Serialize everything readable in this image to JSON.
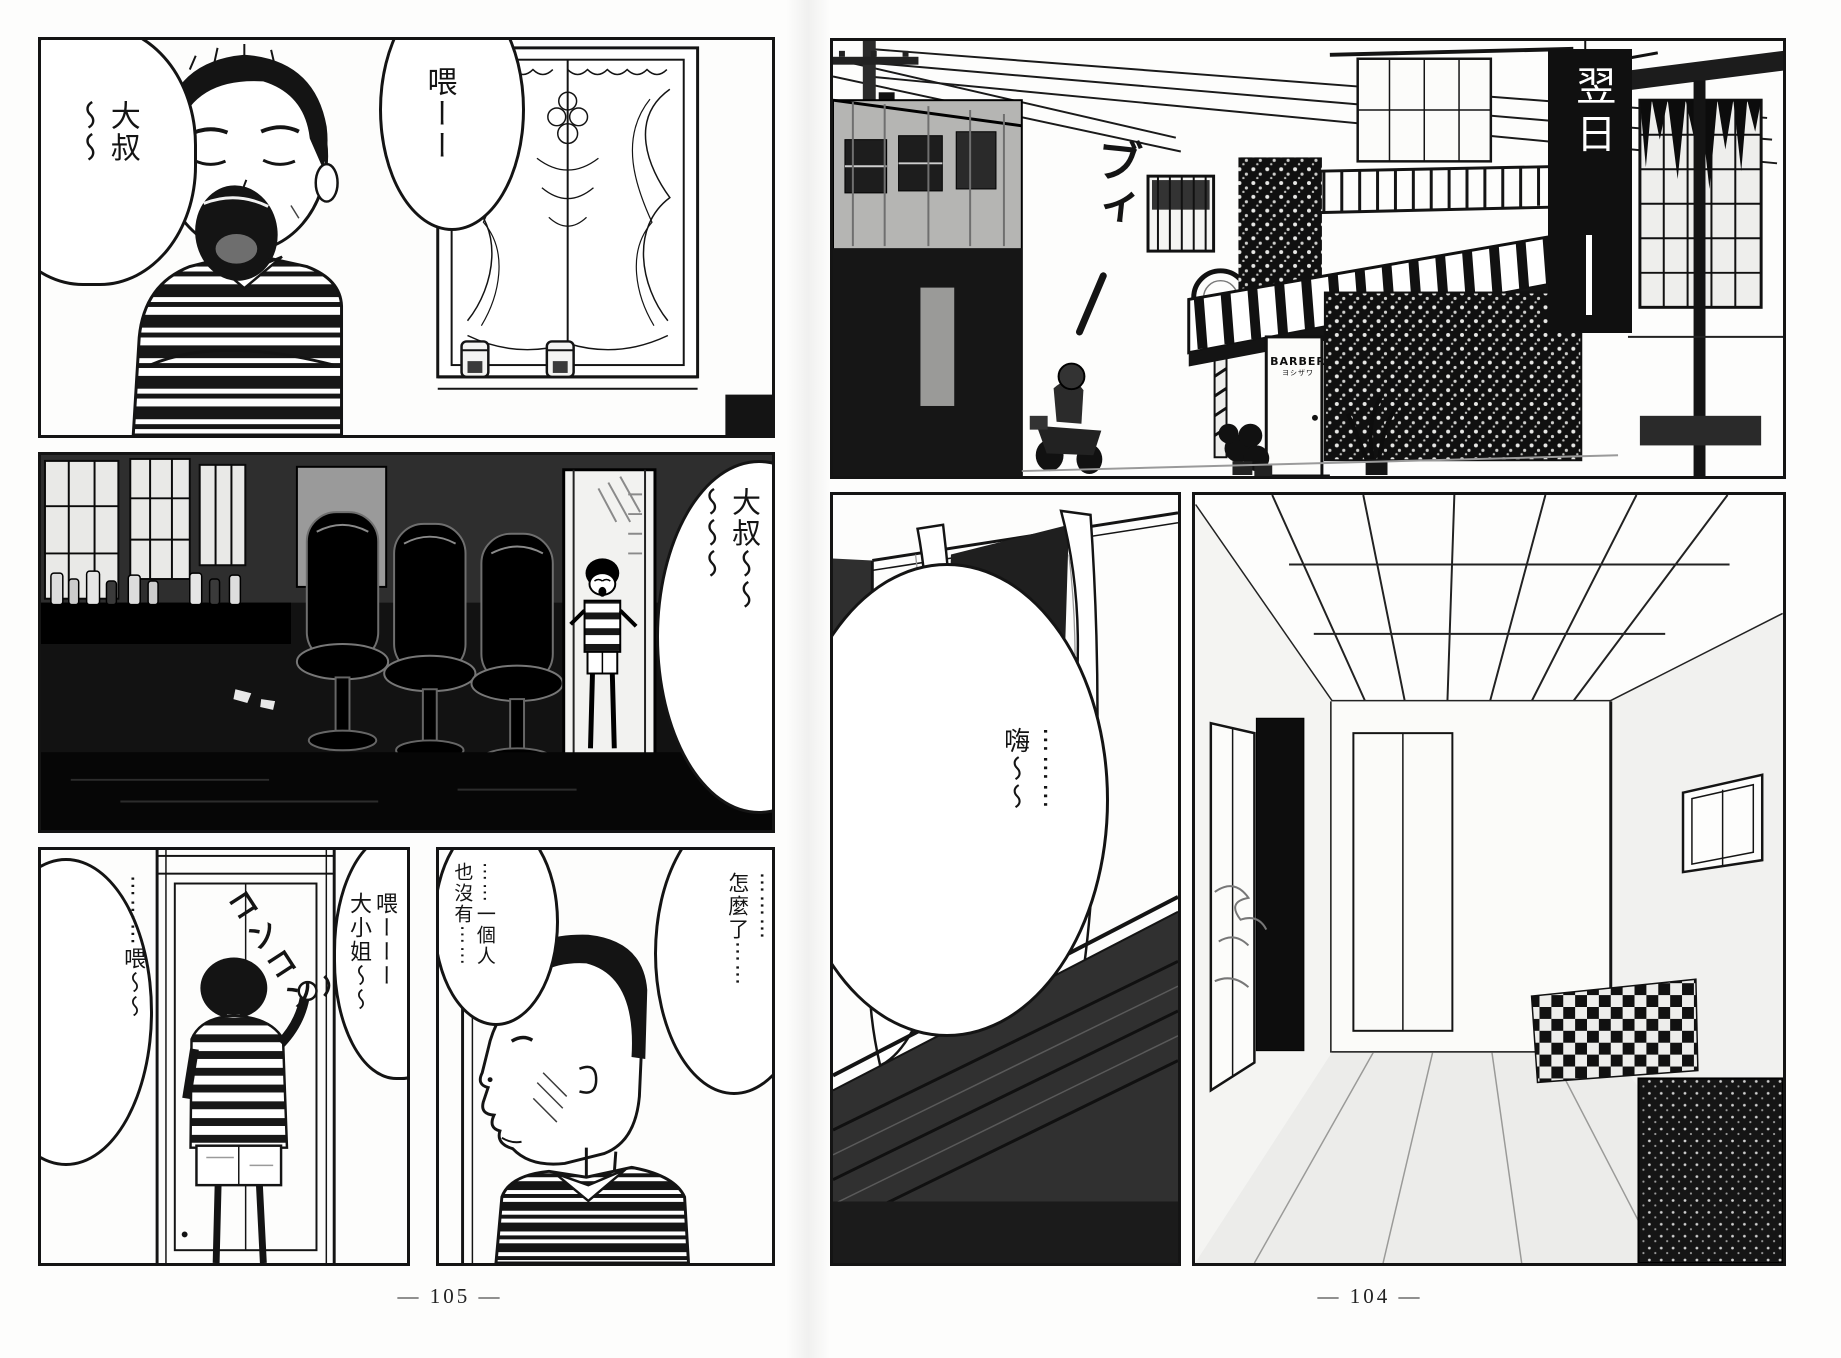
{
  "colors": {
    "paper": "#fdfdfc",
    "ink": "#141414"
  },
  "page_left": {
    "page_number": "— 105 —",
    "panel1": {
      "bubble_left_cols": [
        "大叔",
        "〜〜"
      ],
      "bubble_right_cols": [
        "喂ーー"
      ]
    },
    "panel2": {
      "bubble_cols": [
        "大叔〜〜",
        "〜〜〜"
      ]
    },
    "panel3": {
      "bubble_left_cols": [
        "⋯⋯⋯喂〜〜"
      ],
      "sfx_knock": "コンコン",
      "bubble_right_cols": [
        "喂ーーー",
        "大小姐〜〜"
      ]
    },
    "panel4": {
      "bubble_left_cols": [
        "⋯⋯一個人",
        "也沒有⋯⋯"
      ],
      "bubble_right_cols": [
        "⋯⋯⋯",
        "怎麼了⋯⋯"
      ]
    }
  },
  "page_right": {
    "page_number": "— 104 —",
    "panel1": {
      "banner_text": "翌日",
      "sfx_engine": "ブィ",
      "door_sign": "BARBER",
      "door_sign_sub": "ヨシザワ"
    },
    "panel2": {
      "bubble_cols": [
        "⋯⋯⋯",
        "嗨〜〜"
      ]
    }
  }
}
